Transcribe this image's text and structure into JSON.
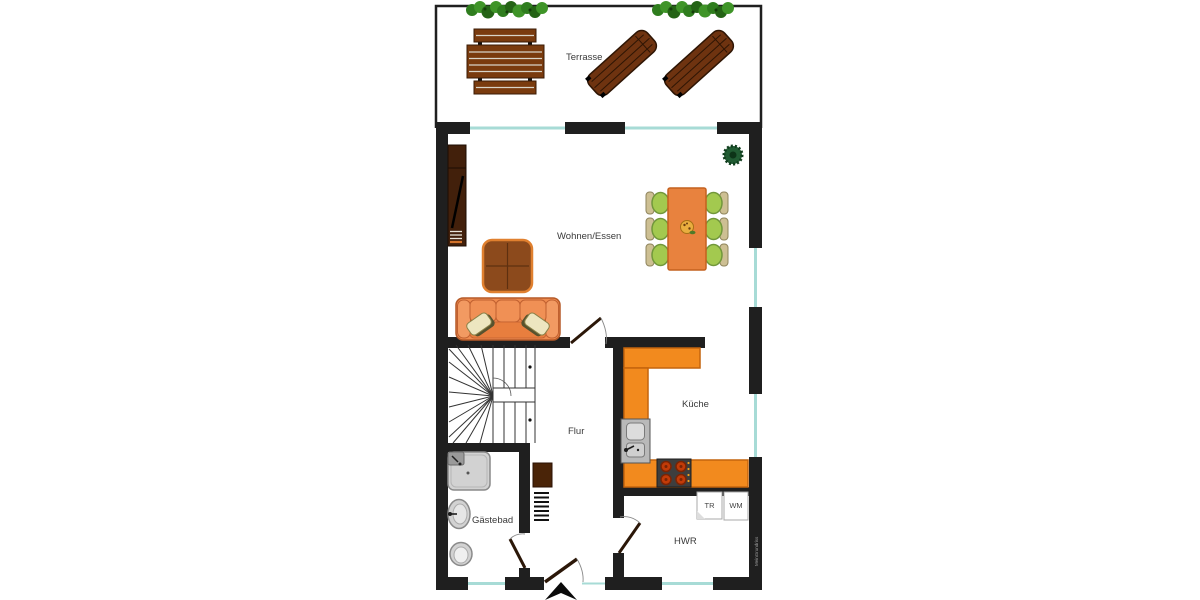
{
  "plan": {
    "labels": {
      "terrasse": "Terrasse",
      "wohnen_essen": "Wohnen/Essen",
      "kueche": "Küche",
      "flur": "Flur",
      "gaestebad": "Gästebad",
      "hwr": "HWR",
      "dryer": "TR",
      "washer": "WM",
      "watermark": "MeinGrundriss"
    },
    "colors": {
      "wall": "#1f1f1f",
      "window": "#a7dbd6",
      "counter": "#f28a1e",
      "counter_border": "#c4640d",
      "sofa": "#ef8b4f",
      "sofa_border": "#b55a28",
      "dining_table": "#e8823e",
      "chair_green": "#a3c94f",
      "chair_back": "#cdbf93",
      "coffee_table": "#8c4a1c",
      "coffee_table_border": "#e0802f",
      "tv_board": "#42200b",
      "terrace_wood": "#7a3b0e",
      "lounger_wood": "#6e3310",
      "hedge_green": "#2f7d1e",
      "plant_green": "#215c33",
      "stove": "#3e3e3e",
      "fixture": "#d2d2d2",
      "label_text": "#3a3a3a"
    }
  }
}
